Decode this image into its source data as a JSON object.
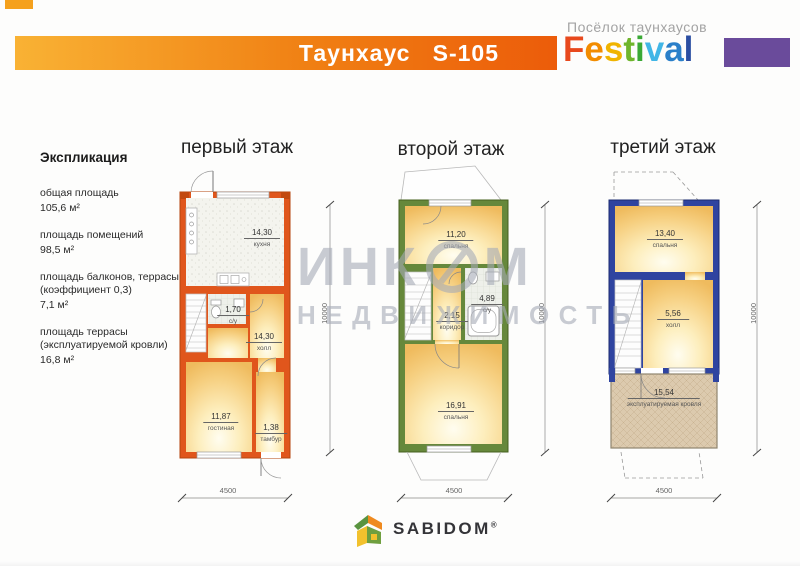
{
  "header": {
    "title": "Таунхаус   S-105",
    "estate_label": "Посёлок таунхаусов",
    "festival_letters": [
      {
        "ch": "F",
        "color": "#e8491d"
      },
      {
        "ch": "e",
        "color": "#f28c00"
      },
      {
        "ch": "s",
        "color": "#f0b400"
      },
      {
        "ch": "t",
        "color": "#6fb52c"
      },
      {
        "ch": "i",
        "color": "#3aa935"
      },
      {
        "ch": "v",
        "color": "#41b6e6"
      },
      {
        "ch": "a",
        "color": "#2a7fc9"
      },
      {
        "ch": "l",
        "color": "#2b4ea2"
      }
    ],
    "brand_block_color": "#6a4b9b",
    "bar_color_left": "#f9b234",
    "bar_color_right": "#ec5c0a"
  },
  "explication": {
    "title": "Экспликация",
    "items": [
      {
        "line1": "общая площадь",
        "line2": "",
        "value": "105,6 м²"
      },
      {
        "line1": "площадь помещений",
        "line2": "",
        "value": "98,5 м²"
      },
      {
        "line1": "площадь балконов, террасы",
        "line2": "(коэффициент 0,3)",
        "value": "7,1 м²"
      },
      {
        "line1": "площадь террасы",
        "line2": "(эксплуатируемой кровли)",
        "value": "16,8 м²"
      }
    ]
  },
  "floors": [
    {
      "title": "первый этаж",
      "wall_color": "#e0561c",
      "rooms": [
        {
          "area": "14,30",
          "name": "кухня"
        },
        {
          "area": "1,70",
          "name": "с/у"
        },
        {
          "area": "14,30",
          "name": "холл"
        },
        {
          "area": "11,87",
          "name": "гостиная"
        },
        {
          "area": "1,38",
          "name": "тамбур"
        }
      ],
      "width_dim": "4500",
      "height_dim": "10000"
    },
    {
      "title": "второй этаж",
      "wall_color": "#66883b",
      "rooms": [
        {
          "area": "11,20",
          "name": "спальня"
        },
        {
          "area": "2,15",
          "name": "коридор"
        },
        {
          "area": "4,89",
          "name": "с/у"
        },
        {
          "area": "16,91",
          "name": "спальня"
        }
      ],
      "width_dim": "4500",
      "height_dim": "10000"
    },
    {
      "title": "третий этаж",
      "wall_color": "#2f44a0",
      "rooms": [
        {
          "area": "13,40",
          "name": "спальня"
        },
        {
          "area": "5,56",
          "name": "холл"
        },
        {
          "area": "15,54",
          "name": "эксплуатируемая кровля"
        }
      ],
      "width_dim": "4500",
      "height_dim": "10000"
    }
  ],
  "watermark": {
    "part1": "ИНК",
    "part2": "М",
    "line2": "НЕДВИЖИМОСТЬ"
  },
  "footer": {
    "brand": "SABIDOM",
    "reg": "®"
  }
}
